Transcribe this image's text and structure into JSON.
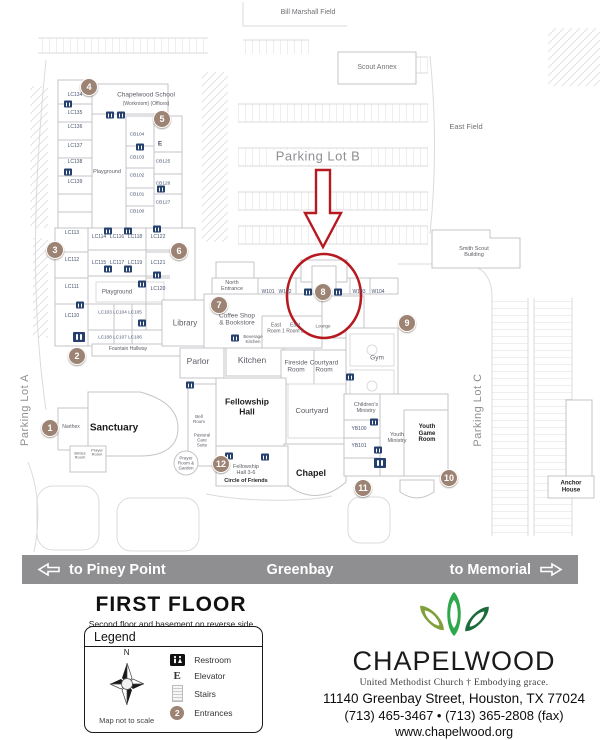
{
  "colors": {
    "highlight_red": "#b6191f",
    "entrance_brown": "#9d8373",
    "restroom_navy": "#26406e",
    "road_banner_gray": "#8f8f91",
    "leaf_light_green": "#7fa03a",
    "leaf_mid_green": "#2fa84b",
    "leaf_dark_green": "#1d6b3c"
  },
  "road": {
    "left": "to Piney Point",
    "center": "Greenbay",
    "right": "to Memorial"
  },
  "floor": {
    "title": "FIRST  FLOOR",
    "subtitle": "Second floor  and basement on reverse side"
  },
  "legend": {
    "title": "Legend",
    "compass_n": "N",
    "not_to_scale": "Map not to scale",
    "elevator_letter": "E",
    "entrance_badge": "2",
    "items": [
      {
        "label": "Restroom"
      },
      {
        "label": "Elevator"
      },
      {
        "label": "Stairs"
      },
      {
        "label": "Entrances"
      }
    ]
  },
  "brand": {
    "name": "CHAPELWOOD",
    "tagline": "United Methodist Church  †  Embodying grace.",
    "address": "11140 Greenbay Street,  Houston, TX 77024",
    "phone": "(713) 465-3467 • (713) 365-2808 (fax)",
    "website": "www.chapelwood.org"
  },
  "map": {
    "labels": [
      {
        "id": "bill-marshall-field",
        "t": "Bill Marshall Field",
        "x": 308,
        "y": 13,
        "fs": 7,
        "c": "field"
      },
      {
        "id": "scout-annex",
        "t": "Scout Annex",
        "x": 377,
        "y": 68,
        "fs": 7,
        "c": "field"
      },
      {
        "id": "east-field",
        "t": "East Field",
        "x": 466,
        "y": 127,
        "fs": 7.5,
        "c": "field"
      },
      {
        "id": "smith-scout-building",
        "t": "Smith Scout\nBuilding",
        "x": 474,
        "y": 252,
        "fs": 5.5,
        "c": "name"
      },
      {
        "id": "anchor-house",
        "t": "Anchor\nHouse",
        "x": 571,
        "y": 487,
        "fs": 6,
        "c": "bold"
      },
      {
        "id": "parking-lot-b",
        "t": "Parking Lot B",
        "x": 318,
        "y": 157,
        "fs": 13,
        "c": "bigpark"
      },
      {
        "id": "parking-lot-a",
        "t": "Parking Lot A",
        "x": 25,
        "y": 410,
        "fs": 11,
        "c": "parking",
        "rot": true
      },
      {
        "id": "parking-lot-c",
        "t": "Parking Lot C",
        "x": 478,
        "y": 410,
        "fs": 11,
        "c": "parking",
        "rot": true
      },
      {
        "id": "chapelwood-school",
        "t": "Chapelwood School",
        "x": 146,
        "y": 95,
        "fs": 6.5,
        "c": "name"
      },
      {
        "id": "school-rooms",
        "t": "(Workroom)   (Offices)",
        "x": 146,
        "y": 105,
        "fs": 5,
        "c": "name"
      },
      {
        "id": "room-lc134",
        "t": "LC134",
        "x": 75,
        "y": 96,
        "fs": 5,
        "c": "code"
      },
      {
        "id": "room-lc135",
        "t": "LC135",
        "x": 75,
        "y": 114,
        "fs": 5,
        "c": "code"
      },
      {
        "id": "room-lc136",
        "t": "LC136",
        "x": 75,
        "y": 128,
        "fs": 5,
        "c": "code"
      },
      {
        "id": "room-lc137",
        "t": "LC137",
        "x": 75,
        "y": 147,
        "fs": 5,
        "c": "code"
      },
      {
        "id": "room-lc138",
        "t": "LC138",
        "x": 75,
        "y": 163,
        "fs": 5,
        "c": "code"
      },
      {
        "id": "room-lc139",
        "t": "LC139",
        "x": 75,
        "y": 183,
        "fs": 5,
        "c": "code"
      },
      {
        "id": "playground-school",
        "t": "Playground",
        "x": 107,
        "y": 172,
        "fs": 5.5,
        "c": "name"
      },
      {
        "id": "room-cb104",
        "t": "CB104",
        "x": 137,
        "y": 135,
        "fs": 4.8,
        "c": "code"
      },
      {
        "id": "room-cb103",
        "t": "CB103",
        "x": 137,
        "y": 158,
        "fs": 4.8,
        "c": "code"
      },
      {
        "id": "room-cb102",
        "t": "CB102",
        "x": 137,
        "y": 176,
        "fs": 4.8,
        "c": "code"
      },
      {
        "id": "room-cb101",
        "t": "CB101",
        "x": 137,
        "y": 195,
        "fs": 4.8,
        "c": "code"
      },
      {
        "id": "room-cb100",
        "t": "CB100",
        "x": 137,
        "y": 212,
        "fs": 4.8,
        "c": "code"
      },
      {
        "id": "room-cb125",
        "t": "CB125",
        "x": 163,
        "y": 162,
        "fs": 4.8,
        "c": "code"
      },
      {
        "id": "room-cb126",
        "t": "CB126",
        "x": 163,
        "y": 184,
        "fs": 4.8,
        "c": "code"
      },
      {
        "id": "room-cb127",
        "t": "CB127",
        "x": 163,
        "y": 203,
        "fs": 4.8,
        "c": "code"
      },
      {
        "id": "room-lc113",
        "t": "LC113",
        "x": 72,
        "y": 234,
        "fs": 5,
        "c": "code"
      },
      {
        "id": "room-lc114",
        "t": "LC114",
        "x": 99,
        "y": 238,
        "fs": 5,
        "c": "code"
      },
      {
        "id": "room-lc116",
        "t": "LC116",
        "x": 117,
        "y": 238,
        "fs": 5,
        "c": "code"
      },
      {
        "id": "room-lc118",
        "t": "LC118",
        "x": 135,
        "y": 238,
        "fs": 5,
        "c": "code"
      },
      {
        "id": "room-lc122",
        "t": "LC122",
        "x": 158,
        "y": 238,
        "fs": 5,
        "c": "code"
      },
      {
        "id": "room-lc112",
        "t": "LC112",
        "x": 72,
        "y": 261,
        "fs": 5,
        "c": "code"
      },
      {
        "id": "room-lc115",
        "t": "LC115",
        "x": 99,
        "y": 264,
        "fs": 5,
        "c": "code"
      },
      {
        "id": "room-lc117",
        "t": "LC117",
        "x": 117,
        "y": 264,
        "fs": 5,
        "c": "code"
      },
      {
        "id": "room-lc119",
        "t": "LC119",
        "x": 135,
        "y": 264,
        "fs": 5,
        "c": "code"
      },
      {
        "id": "room-lc121",
        "t": "LC121",
        "x": 158,
        "y": 264,
        "fs": 5,
        "c": "code"
      },
      {
        "id": "room-lc111",
        "t": "LC111",
        "x": 72,
        "y": 288,
        "fs": 5,
        "c": "code"
      },
      {
        "id": "playground-wing",
        "t": "Playground",
        "x": 117,
        "y": 293,
        "fs": 6,
        "c": "name"
      },
      {
        "id": "room-lc120",
        "t": "LC120",
        "x": 158,
        "y": 290,
        "fs": 5,
        "c": "code"
      },
      {
        "id": "room-lc110",
        "t": "LC110",
        "x": 72,
        "y": 317,
        "fs": 5,
        "c": "code"
      },
      {
        "id": "room-lc103",
        "t": "LC103",
        "x": 105,
        "y": 312,
        "fs": 4.6,
        "c": "code"
      },
      {
        "id": "room-lc104",
        "t": "LC104",
        "x": 120,
        "y": 312,
        "fs": 4.6,
        "c": "code"
      },
      {
        "id": "room-lc105",
        "t": "LC105",
        "x": 135,
        "y": 312,
        "fs": 4.6,
        "c": "code"
      },
      {
        "id": "room-lc108",
        "t": "LC108",
        "x": 105,
        "y": 337,
        "fs": 4.6,
        "c": "code"
      },
      {
        "id": "room-lc107",
        "t": "LC107",
        "x": 120,
        "y": 337,
        "fs": 4.6,
        "c": "code"
      },
      {
        "id": "room-lc106",
        "t": "LC106",
        "x": 135,
        "y": 337,
        "fs": 4.6,
        "c": "code"
      },
      {
        "id": "fountain-hallway",
        "t": "Fountain Hallway",
        "x": 128,
        "y": 350,
        "fs": 5,
        "c": "name"
      },
      {
        "id": "library",
        "t": "Library",
        "x": 185,
        "y": 324,
        "fs": 8,
        "c": "name"
      },
      {
        "id": "north-entrance",
        "t": "North\nEntrance",
        "x": 232,
        "y": 286,
        "fs": 5.5,
        "c": "name"
      },
      {
        "id": "coffee-shop",
        "t": "Coffee Shop\n& Bookstore",
        "x": 237,
        "y": 320,
        "fs": 6.5,
        "c": "name"
      },
      {
        "id": "beverage-kitchen",
        "t": "Beverage\nKitchen",
        "x": 253,
        "y": 339,
        "fs": 4.5,
        "c": "name"
      },
      {
        "id": "east-room-1",
        "t": "East\nRoom 1",
        "x": 276,
        "y": 329,
        "fs": 5,
        "c": "name"
      },
      {
        "id": "east-room-2",
        "t": "East\nRoom 2",
        "x": 295,
        "y": 329,
        "fs": 5,
        "c": "name"
      },
      {
        "id": "lounge",
        "t": "Lounge",
        "x": 323,
        "y": 326,
        "fs": 4.5,
        "c": "name"
      },
      {
        "id": "room-w101",
        "t": "W101",
        "x": 268,
        "y": 293,
        "fs": 5,
        "c": "code"
      },
      {
        "id": "room-w102",
        "t": "W102",
        "x": 285,
        "y": 293,
        "fs": 5,
        "c": "code"
      },
      {
        "id": "room-w103",
        "t": "W103",
        "x": 359,
        "y": 293,
        "fs": 5,
        "c": "code"
      },
      {
        "id": "room-w104",
        "t": "W104",
        "x": 378,
        "y": 293,
        "fs": 5,
        "c": "code"
      },
      {
        "id": "parlor",
        "t": "Parlor",
        "x": 198,
        "y": 362,
        "fs": 8.5,
        "c": "name"
      },
      {
        "id": "kitchen",
        "t": "Kitchen",
        "x": 252,
        "y": 361,
        "fs": 8.5,
        "c": "name"
      },
      {
        "id": "fireside-room",
        "t": "Fireside\nRoom",
        "x": 296,
        "y": 367,
        "fs": 6.5,
        "c": "name"
      },
      {
        "id": "courtyard-room",
        "t": "Courtyard\nRoom",
        "x": 324,
        "y": 367,
        "fs": 6.5,
        "c": "name"
      },
      {
        "id": "fellowship-hall",
        "t": "Fellowship\nHall",
        "x": 247,
        "y": 407,
        "fs": 8.5,
        "c": "bold"
      },
      {
        "id": "courtyard",
        "t": "Courtyard",
        "x": 312,
        "y": 411,
        "fs": 7.5,
        "c": "name"
      },
      {
        "id": "gym",
        "t": "Gym",
        "x": 377,
        "y": 358,
        "fs": 6.5,
        "c": "name"
      },
      {
        "id": "childrens-ministry",
        "t": "Children's\nMinistry",
        "x": 366,
        "y": 408,
        "fs": 5.5,
        "c": "name"
      },
      {
        "id": "room-yb100",
        "t": "YB100",
        "x": 359,
        "y": 430,
        "fs": 5,
        "c": "code"
      },
      {
        "id": "room-yb101",
        "t": "YB101",
        "x": 359,
        "y": 447,
        "fs": 5,
        "c": "code"
      },
      {
        "id": "youth-ministry",
        "t": "Youth\nMinistry",
        "x": 397,
        "y": 438,
        "fs": 5.5,
        "c": "name"
      },
      {
        "id": "youth-game-room",
        "t": "Youth\nGame\nRoom",
        "x": 427,
        "y": 434,
        "fs": 6,
        "c": "bold"
      },
      {
        "id": "bell-room",
        "t": "Bell\nRoom",
        "x": 199,
        "y": 419,
        "fs": 4.5,
        "c": "name"
      },
      {
        "id": "pastoral-care-suite",
        "t": "Pastoral\nCare\nSuite",
        "x": 202,
        "y": 440,
        "fs": 4.5,
        "c": "name"
      },
      {
        "id": "prayer-room-garden",
        "t": "Prayer\nRoom &\nGarden",
        "x": 186,
        "y": 463,
        "fs": 4.5,
        "c": "name"
      },
      {
        "id": "sanctuary",
        "t": "Sanctuary",
        "x": 114,
        "y": 428,
        "fs": 10,
        "c": "bold"
      },
      {
        "id": "narthex",
        "t": "Narthex",
        "x": 71,
        "y": 428,
        "fs": 5,
        "c": "name"
      },
      {
        "id": "brides-room",
        "t": "Brides\nRoom",
        "x": 80,
        "y": 456,
        "fs": 4,
        "c": "name"
      },
      {
        "id": "prayer-room",
        "t": "Prayer\nRoom",
        "x": 97,
        "y": 453,
        "fs": 4,
        "c": "name"
      },
      {
        "id": "fellowship-hall-36",
        "t": "Fellowship\nHall 3-6",
        "x": 246,
        "y": 470,
        "fs": 5.5,
        "c": "name"
      },
      {
        "id": "circle-of-friends",
        "t": "Circle of Friends",
        "x": 246,
        "y": 481,
        "fs": 5.5,
        "c": "bold"
      },
      {
        "id": "chapel",
        "t": "Chapel",
        "x": 311,
        "y": 473,
        "fs": 9,
        "c": "bold"
      }
    ],
    "entrances": [
      {
        "n": "1",
        "x": 50,
        "y": 428
      },
      {
        "n": "2",
        "x": 77,
        "y": 356
      },
      {
        "n": "3",
        "x": 55,
        "y": 250
      },
      {
        "n": "4",
        "x": 89,
        "y": 87
      },
      {
        "n": "5",
        "x": 162,
        "y": 119
      },
      {
        "n": "6",
        "x": 179,
        "y": 251
      },
      {
        "n": "7",
        "x": 219,
        "y": 305
      },
      {
        "n": "8",
        "x": 323,
        "y": 292
      },
      {
        "n": "9",
        "x": 407,
        "y": 323
      },
      {
        "n": "10",
        "x": 449,
        "y": 478
      },
      {
        "n": "11",
        "x": 363,
        "y": 488
      },
      {
        "n": "12",
        "x": 221,
        "y": 464
      }
    ],
    "restrooms": [
      {
        "x": 68,
        "y": 104
      },
      {
        "x": 68,
        "y": 172
      },
      {
        "x": 110,
        "y": 115
      },
      {
        "x": 121,
        "y": 115
      },
      {
        "x": 140,
        "y": 147
      },
      {
        "x": 161,
        "y": 189
      },
      {
        "x": 108,
        "y": 231
      },
      {
        "x": 128,
        "y": 231
      },
      {
        "x": 157,
        "y": 229
      },
      {
        "x": 108,
        "y": 269
      },
      {
        "x": 128,
        "y": 269
      },
      {
        "x": 157,
        "y": 275
      },
      {
        "x": 142,
        "y": 284
      },
      {
        "x": 80,
        "y": 305
      },
      {
        "x": 142,
        "y": 323
      },
      {
        "x": 79,
        "y": 337,
        "b": true
      },
      {
        "x": 235,
        "y": 338
      },
      {
        "x": 308,
        "y": 292
      },
      {
        "x": 338,
        "y": 292
      },
      {
        "x": 190,
        "y": 385
      },
      {
        "x": 229,
        "y": 456
      },
      {
        "x": 265,
        "y": 457
      },
      {
        "x": 350,
        "y": 377
      },
      {
        "x": 374,
        "y": 422
      },
      {
        "x": 378,
        "y": 450
      },
      {
        "x": 380,
        "y": 463,
        "b": true
      }
    ],
    "elevators": [
      {
        "x": 160,
        "y": 144
      }
    ]
  }
}
